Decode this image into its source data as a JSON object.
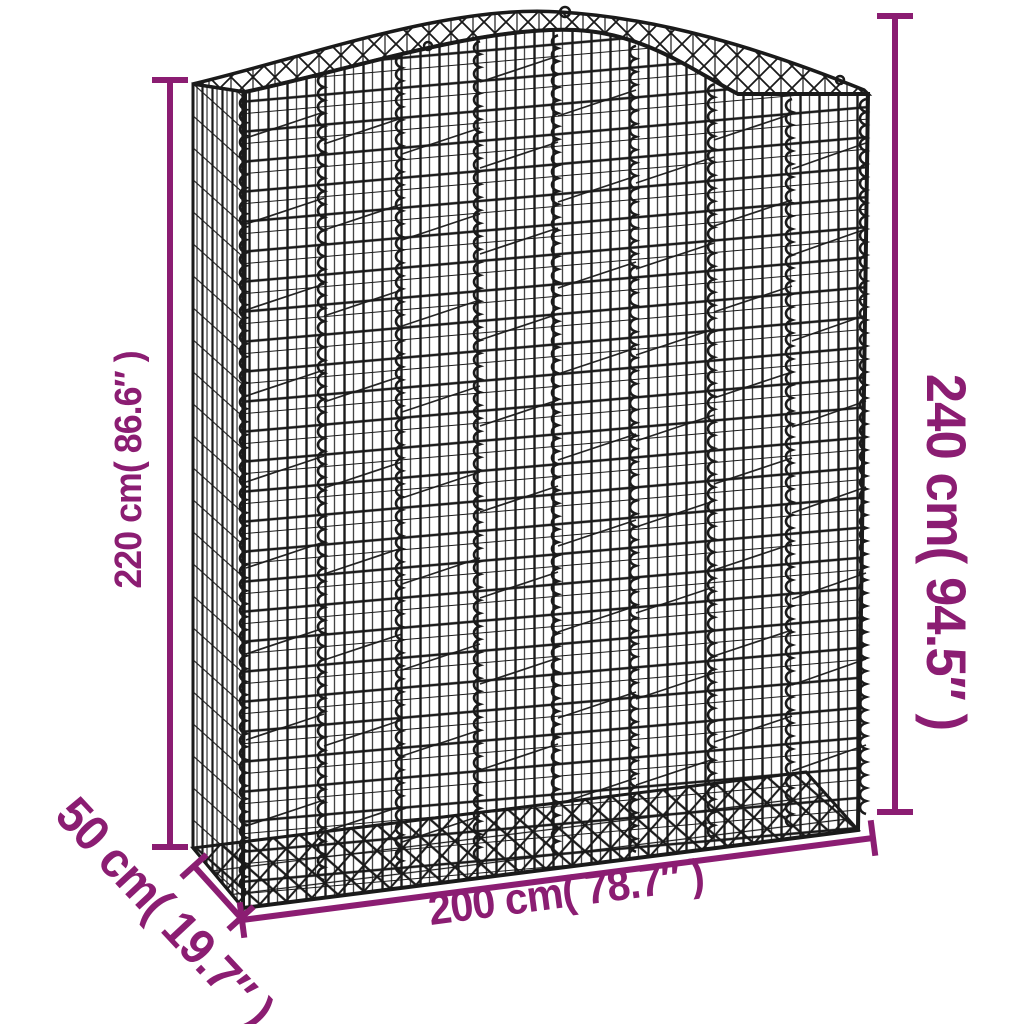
{
  "page": {
    "background": "#ffffff",
    "description": "Product dimension diagram of a black wire-mesh gabion basket with an arched top, drawn in three-quarter perspective on a white background"
  },
  "colors": {
    "dimension_accent": "#8b1d72",
    "wire": "#1a1a1a",
    "background": "#ffffff"
  },
  "dimensions": {
    "height_left": {
      "text": "220 cm( 86.6″ )",
      "value_cm": 220,
      "value_in": 86.6
    },
    "height_right": {
      "text": "240 cm( 94.5″ )",
      "value_cm": 240,
      "value_in": 94.5
    },
    "width_bottom": {
      "text": "200 cm( 78.7″ )",
      "value_cm": 200,
      "value_in": 78.7
    },
    "depth_bottom_left": {
      "text": "50 cm( 19.7″ )",
      "value_cm": 50,
      "value_in": 19.7
    }
  }
}
